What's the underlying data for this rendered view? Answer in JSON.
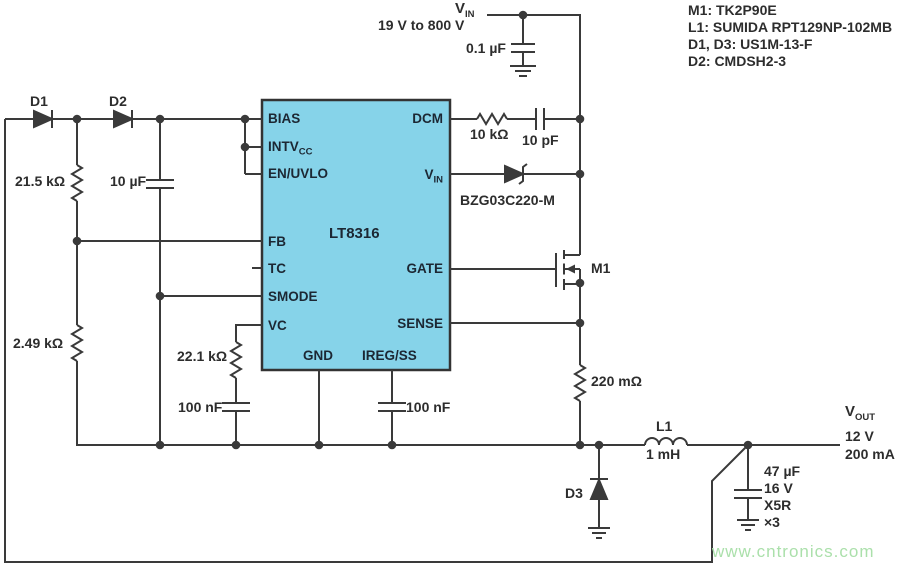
{
  "colors": {
    "wire": "#3a3a3a",
    "ic_fill": "#86d3e9",
    "ic_border": "#333333",
    "label_text": "#2d2d2d",
    "ic_text": "#1c2733",
    "watermark": "#abe0ab"
  },
  "input": {
    "v": "V",
    "v_sub": "IN",
    "range": "19 V to 800 V",
    "cap": "0.1 µF"
  },
  "parts_list": [
    "M1: TK2P90E",
    "L1: SUMIDA RPT129NP-102MB",
    "D1, D3: US1M-13-F",
    "D2: CMDSH2-3"
  ],
  "ic": {
    "name": "LT8316",
    "pins": {
      "bias": "BIAS",
      "intvcc": "INTV",
      "intvcc_sub": "CC",
      "enuvlo": "EN/UVLO",
      "fb": "FB",
      "tc": "TC",
      "smode": "SMODE",
      "vc": "VC",
      "gnd": "GND",
      "iregss": "IREG/SS",
      "dcm": "DCM",
      "vin": "V",
      "vin_sub": "IN",
      "gate": "GATE",
      "sense": "SENSE"
    }
  },
  "components": {
    "d1": "D1",
    "d2": "D2",
    "r_bias": "21.5 kΩ",
    "c_bias": "10 µF",
    "r_fb": "2.49 kΩ",
    "r_vc": "22.1 kΩ",
    "c_vc": "100 nF",
    "c_ss": "100 nF",
    "r_dcm": "10 kΩ",
    "c_dcm": "10 pF",
    "zener": "BZG03C220-M",
    "m1": "M1",
    "r_sense": "220 mΩ",
    "d3": "D3",
    "l1": "L1",
    "l1_value": "1 mH",
    "c_out": [
      "47 µF",
      "16 V",
      "X5R",
      "×3"
    ]
  },
  "output": {
    "v": "V",
    "v_sub": "OUT",
    "voltage": "12 V",
    "current": "200 mA"
  },
  "watermark": "www.cntronics.com"
}
